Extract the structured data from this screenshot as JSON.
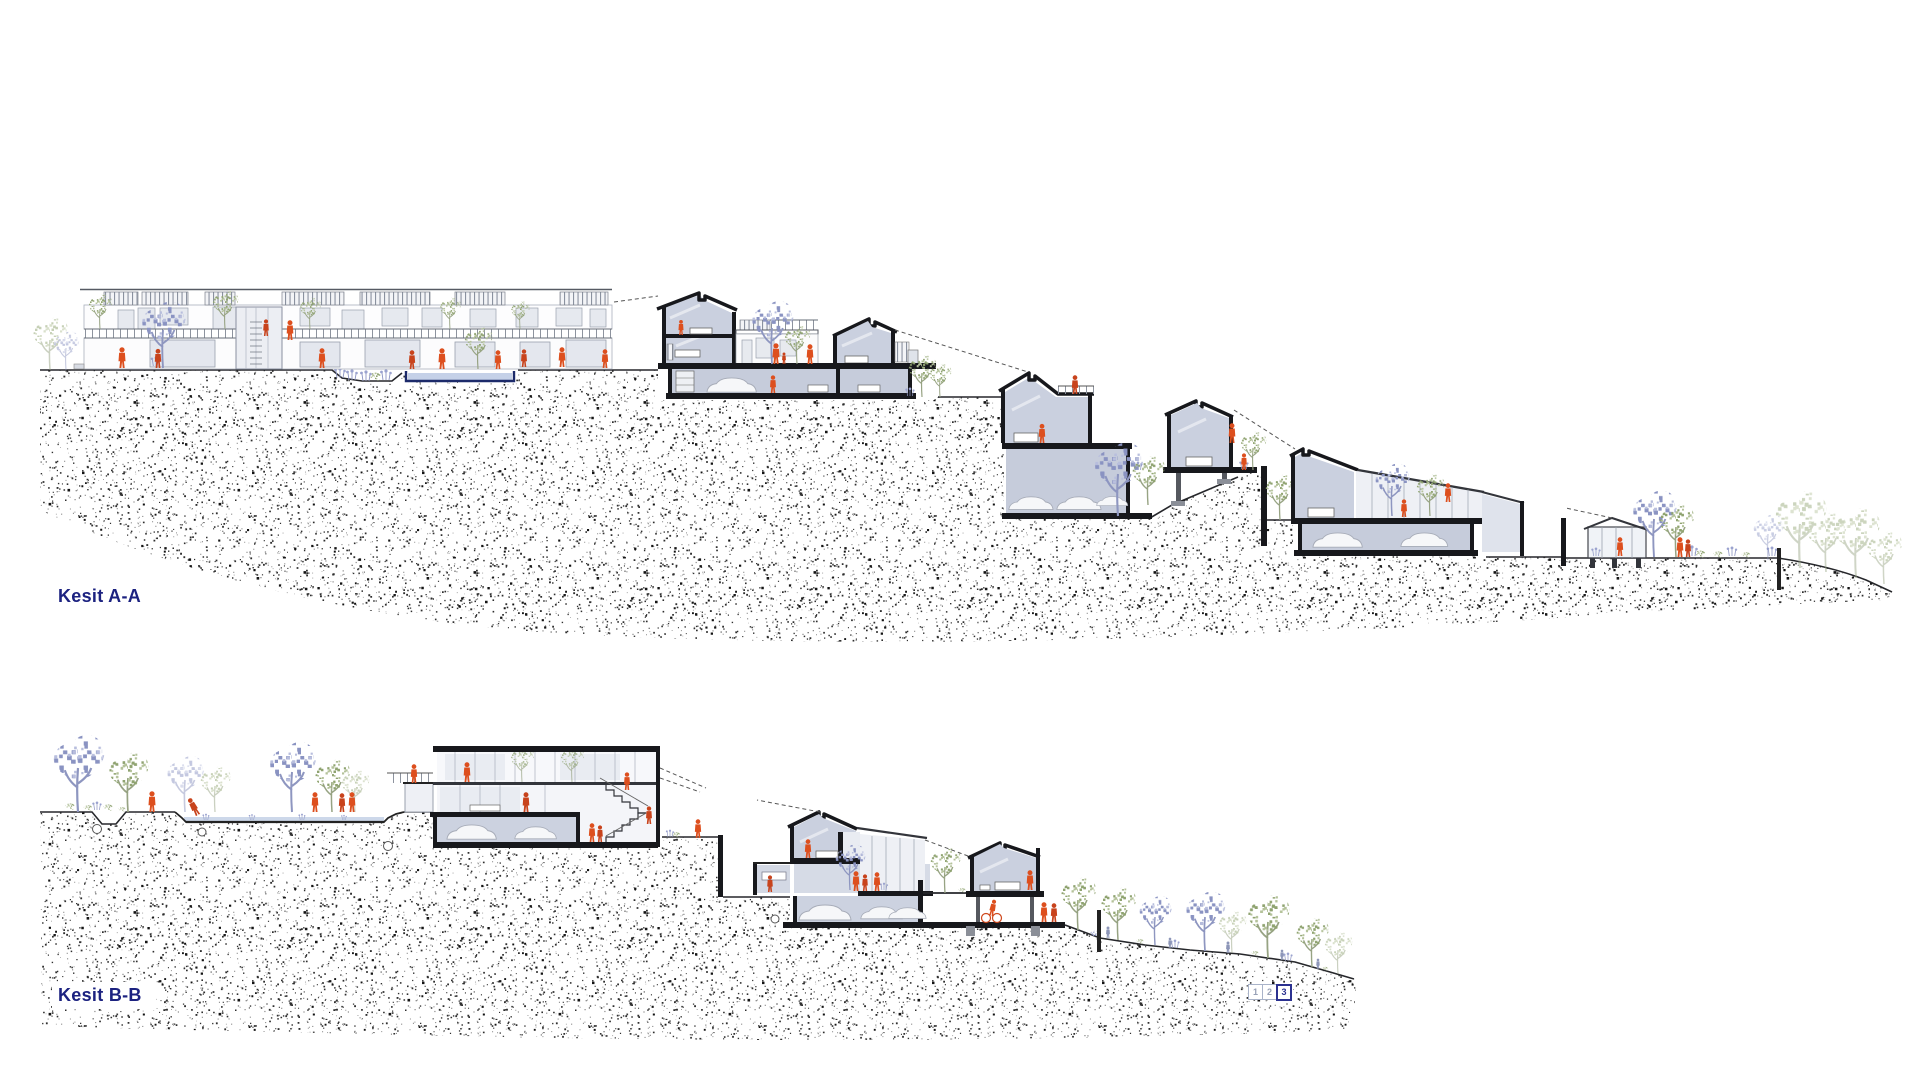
{
  "sections": [
    {
      "id": "A",
      "label": "Kesit A-A"
    },
    {
      "id": "B",
      "label": "Kesit B-B"
    }
  ],
  "pager": {
    "pages": [
      "1",
      "2",
      "3"
    ],
    "active_page": "3"
  },
  "colors": {
    "label_text": "#1c2280",
    "figure_orange": "#dd4f1e",
    "pool_outline": "#1c2a6a",
    "section_cut": "#17181c",
    "interior_fill": "#cad0df",
    "tree_sage": "#8fa370",
    "tree_lavender": "#8a93c2"
  }
}
